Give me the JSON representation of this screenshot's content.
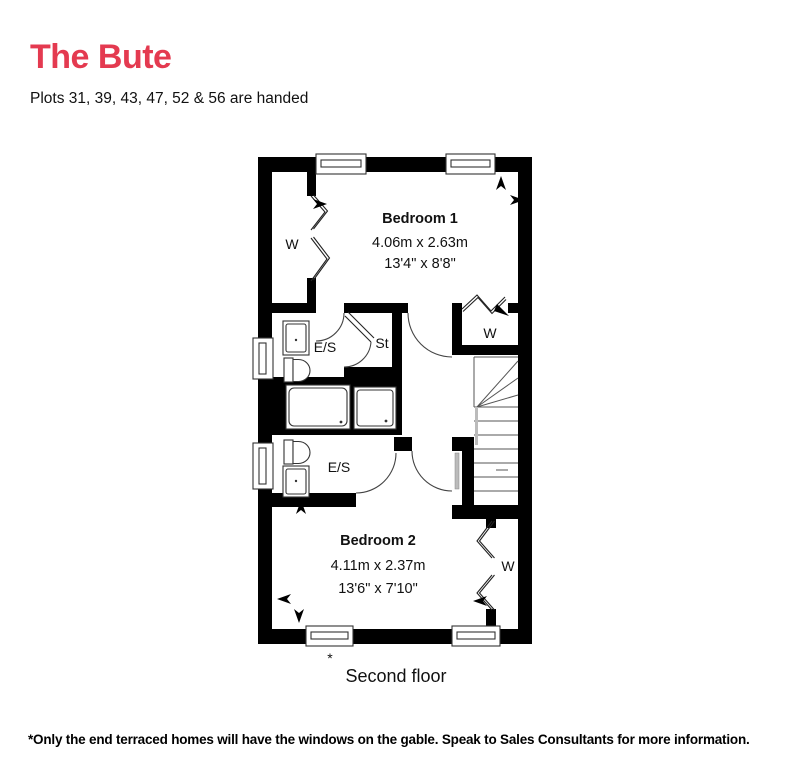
{
  "header": {
    "title": "The Bute",
    "subtitle": "Plots 31, 39, 43, 47, 52 & 56 are handed"
  },
  "colors": {
    "accent": "#e43a50",
    "walls": "#000000",
    "lines": "#444444"
  },
  "plan": {
    "floor_type": "floorplan",
    "bedroom1": {
      "name": "Bedroom 1",
      "metric": "4.06m x 2.63m",
      "imperial": "13'4\" x 8'8\""
    },
    "bedroom2": {
      "name": "Bedroom 2",
      "metric": "4.11m x 2.37m",
      "imperial": "13'6\" x 7'10\""
    },
    "ensuite1": "E/S",
    "ensuite2": "E/S",
    "store": "St",
    "wardrobe1": "W",
    "wardrobe2": "W",
    "wardrobe3": "W",
    "window_note_marker": "*"
  },
  "caption": "Second floor",
  "footnote": "*Only the end terraced homes will have the windows on the gable. Speak to Sales Consultants for more information."
}
